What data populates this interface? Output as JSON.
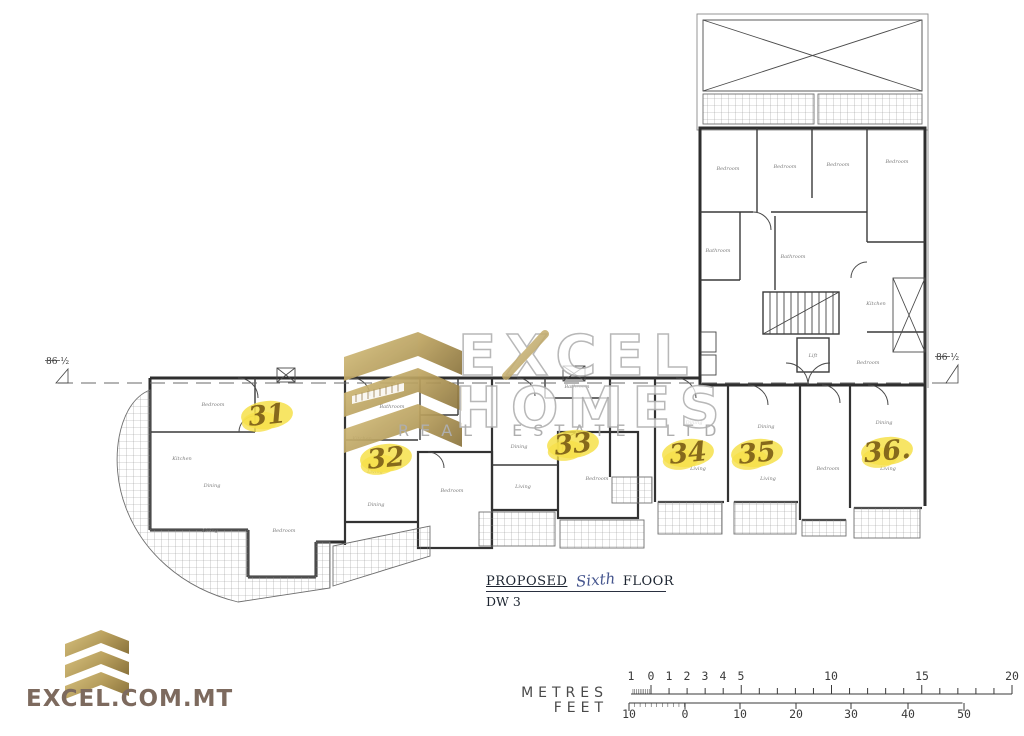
{
  "watermark": {
    "brand_line1": "EXCEL",
    "brand_line2": "HOMES",
    "brand_line3": "REAL ESTATE LTD"
  },
  "title_block": {
    "proposed_label": "PROPOSED",
    "floor_name_handwritten": "Sixth",
    "floor_label": "FLOOR",
    "dwelling_ref": "DW 3"
  },
  "datum": {
    "label": "86 ½",
    "left": {
      "x": 46,
      "y": 364
    },
    "right": {
      "x": 936,
      "y": 360
    }
  },
  "units": [
    {
      "number": "31",
      "x": 267,
      "y": 415
    },
    {
      "number": "32",
      "x": 386,
      "y": 458
    },
    {
      "number": "33",
      "x": 573,
      "y": 444
    },
    {
      "number": "34",
      "x": 688,
      "y": 453
    },
    {
      "number": "35",
      "x": 757,
      "y": 453
    },
    {
      "number": "36.",
      "x": 887,
      "y": 451
    }
  ],
  "rooms": [
    {
      "t": "Bedroom",
      "x": 728,
      "y": 170
    },
    {
      "t": "Bedroom",
      "x": 785,
      "y": 168
    },
    {
      "t": "Bedroom",
      "x": 838,
      "y": 166
    },
    {
      "t": "Bedroom",
      "x": 897,
      "y": 163
    },
    {
      "t": "Bathroom",
      "x": 718,
      "y": 252
    },
    {
      "t": "Bathroom",
      "x": 793,
      "y": 258
    },
    {
      "t": "Kitchen",
      "x": 876,
      "y": 305
    },
    {
      "t": "Bedroom",
      "x": 868,
      "y": 364
    },
    {
      "t": "Lift",
      "x": 813,
      "y": 357
    },
    {
      "t": "Bedroom",
      "x": 213,
      "y": 406
    },
    {
      "t": "Kitchen",
      "x": 182,
      "y": 460
    },
    {
      "t": "Dining",
      "x": 212,
      "y": 487
    },
    {
      "t": "Living",
      "x": 210,
      "y": 532
    },
    {
      "t": "Bedroom",
      "x": 284,
      "y": 532
    },
    {
      "t": "Kitchen",
      "x": 362,
      "y": 440
    },
    {
      "t": "Living",
      "x": 375,
      "y": 473
    },
    {
      "t": "Dining",
      "x": 376,
      "y": 506
    },
    {
      "t": "Bedroom",
      "x": 452,
      "y": 492
    },
    {
      "t": "Bathroom",
      "x": 392,
      "y": 408
    },
    {
      "t": "Dining",
      "x": 519,
      "y": 448
    },
    {
      "t": "Living",
      "x": 523,
      "y": 488
    },
    {
      "t": "Bedroom",
      "x": 597,
      "y": 480
    },
    {
      "t": "Bathroom",
      "x": 577,
      "y": 388
    },
    {
      "t": "Dining",
      "x": 694,
      "y": 424
    },
    {
      "t": "Living",
      "x": 698,
      "y": 470
    },
    {
      "t": "Dining",
      "x": 766,
      "y": 428
    },
    {
      "t": "Living",
      "x": 768,
      "y": 480
    },
    {
      "t": "Bedroom",
      "x": 828,
      "y": 470
    },
    {
      "t": "Dining",
      "x": 884,
      "y": 424
    },
    {
      "t": "Living",
      "x": 888,
      "y": 470
    }
  ],
  "scale_bar": {
    "metres_label": "METRES",
    "feet_label": "FEET",
    "metres": {
      "axis_y": 694,
      "label_y": 680,
      "start_x": 633,
      "zero_x": 651,
      "px_per_unit": 18.05,
      "max_units": 20,
      "labels": [
        [
          631,
          "1"
        ],
        [
          651,
          "0"
        ],
        [
          669,
          "1"
        ],
        [
          687,
          "2"
        ],
        [
          705,
          "3"
        ],
        [
          723,
          "4"
        ],
        [
          741,
          "5"
        ],
        [
          831,
          "10"
        ],
        [
          922,
          "15"
        ],
        [
          1012,
          "20"
        ]
      ]
    },
    "feet": {
      "axis_y": 703,
      "label_y": 718,
      "start_x": 629,
      "zero_x": 685,
      "px_per_unit": 5.55,
      "max_units": 50,
      "labels": [
        [
          629,
          "10"
        ],
        [
          685,
          "0"
        ],
        [
          740,
          "10"
        ],
        [
          796,
          "20"
        ],
        [
          851,
          "30"
        ],
        [
          908,
          "40"
        ],
        [
          964,
          "50"
        ]
      ]
    }
  },
  "footer": {
    "logo_text": "EXCEL.COM.MT"
  },
  "colors": {
    "highlight": "#f6e04a",
    "unit_ink": "#86691c",
    "hand_blue": "#46568e",
    "gold_light": "#d9c27f",
    "gold_dark": "#a68e4e",
    "gold_deep": "#8a733c",
    "wall": "#2e2e2e",
    "watermark_stroke": "#b2b2b2",
    "logo_text": "#7d6a5e"
  }
}
